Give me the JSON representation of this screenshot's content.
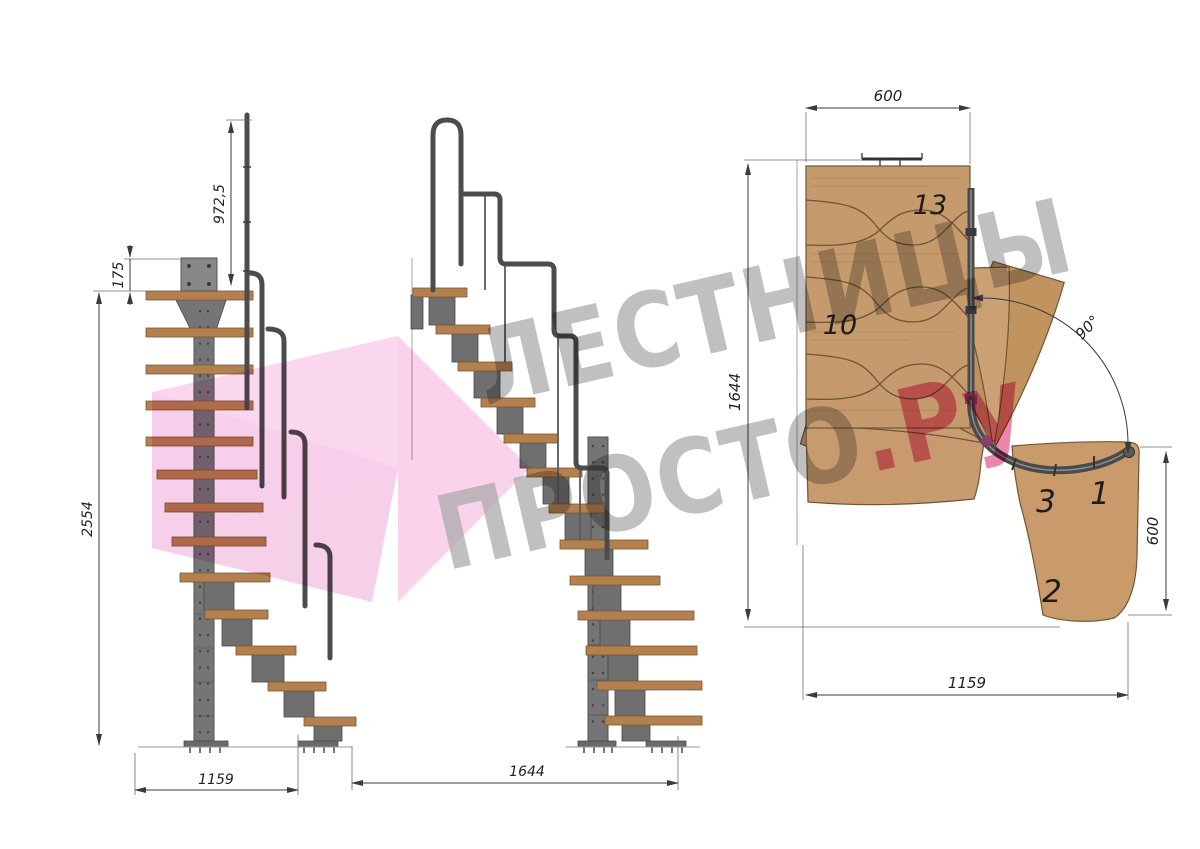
{
  "drawing": {
    "left_view": {
      "dims": {
        "handrail_height": "972,5",
        "top_plate_offset": "175",
        "total_height": "2554",
        "run_length": "1159"
      }
    },
    "middle_view": {
      "dims": {
        "run_length": "1644"
      }
    },
    "plan_view": {
      "dims": {
        "top_width": "600",
        "flight_length": "1644",
        "turn_angle": "90°",
        "entry_width": "600",
        "bottom_length": "1159"
      },
      "steps": {
        "top": "13",
        "upper": "10",
        "turn": "3",
        "entry": "1",
        "second": "2"
      }
    },
    "watermark": {
      "line1": "ЛЕСТНИЦЫ",
      "line2": "ПРОСТО",
      "accent": ".Ру"
    },
    "colors": {
      "wood": "#c59a6c",
      "tread": "#b5804f",
      "steel": "#747474",
      "rail": "#4a4a4a",
      "dimension": "#3a3a3a",
      "watermark_gray": "#a8a8a8",
      "watermark_pink": "#e2568e",
      "arrow_pink": "#f2aedd"
    }
  }
}
